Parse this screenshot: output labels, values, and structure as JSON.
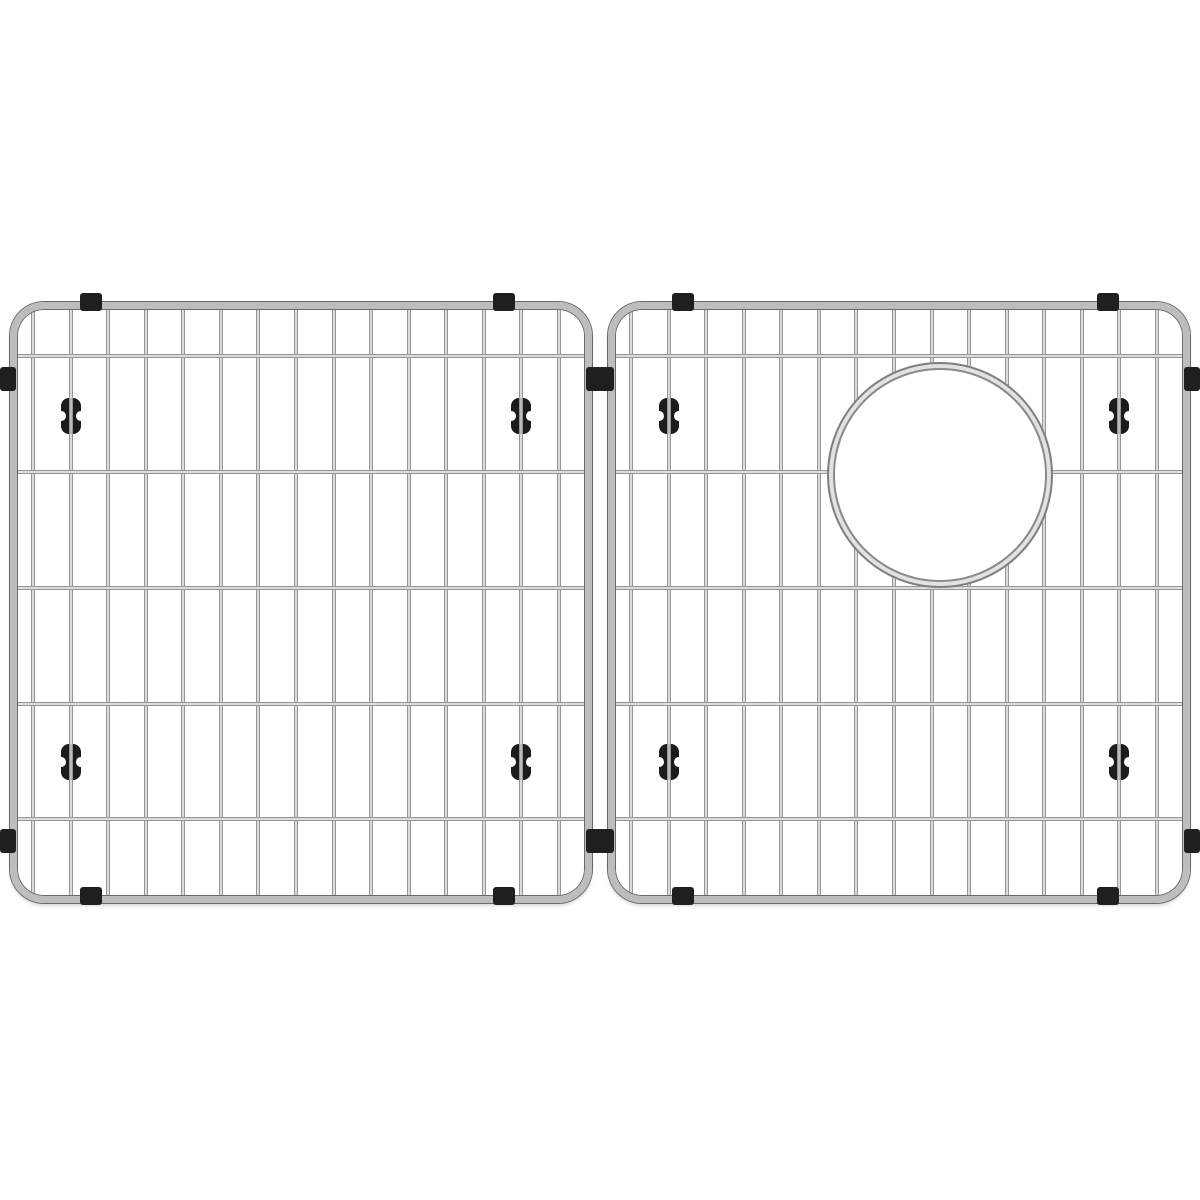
{
  "page": {
    "background_color": "#ffffff",
    "canvas_width": 1200,
    "canvas_height": 1200,
    "description": "Product photo on white background: two-piece stainless steel sink bottom grid set; left grid plain, right grid with round drain opening; black rubber feet, mounting clips and side bumpers."
  },
  "colors": {
    "steel_edge": "#6e6e6e",
    "steel_mid": "#b5b5b5",
    "steel_highlight": "#fafafa",
    "frame_fill": "#bdbdbd",
    "frame_edge": "#6a6a6a",
    "rubber_black": "#1b1b1b",
    "clip_black": "#1f1f1f",
    "ring_light": "#e2e2e2",
    "ring_edge": "#7f7f7f",
    "foot_wire_light": "#cfcfcf",
    "foot_wire_dark": "#808080"
  },
  "grids": [
    {
      "name": "left-sink-grid",
      "x": 10,
      "y": 302,
      "width": 582,
      "height": 601,
      "corner_radius": 34,
      "frame_thickness": 7,
      "vertical_wires": {
        "count": 15,
        "first_x": 23,
        "last_x": 549,
        "wire_width": 4
      },
      "horizontal_wire_ys": [
        54,
        170,
        286,
        402,
        517
      ],
      "foot_wire_indexes": [
        1,
        13
      ],
      "foot_center_ys": [
        114,
        460
      ],
      "clip_center_xs": [
        81,
        494
      ],
      "bumper_center_ys": [
        77,
        539
      ],
      "hole": null
    },
    {
      "name": "right-sink-grid",
      "x": 608,
      "y": 302,
      "width": 582,
      "height": 601,
      "corner_radius": 34,
      "frame_thickness": 7,
      "vertical_wires": {
        "count": 15,
        "first_x": 23,
        "last_x": 549,
        "wire_width": 4
      },
      "horizontal_wire_ys": [
        54,
        170,
        286,
        402,
        517
      ],
      "foot_wire_indexes": [
        1,
        13
      ],
      "foot_center_ys": [
        114,
        460
      ],
      "clip_center_xs": [
        75,
        500
      ],
      "bumper_center_ys": [
        77,
        539
      ],
      "hole": {
        "center_x": 332,
        "center_y": 173,
        "outer_radius": 113
      }
    }
  ]
}
